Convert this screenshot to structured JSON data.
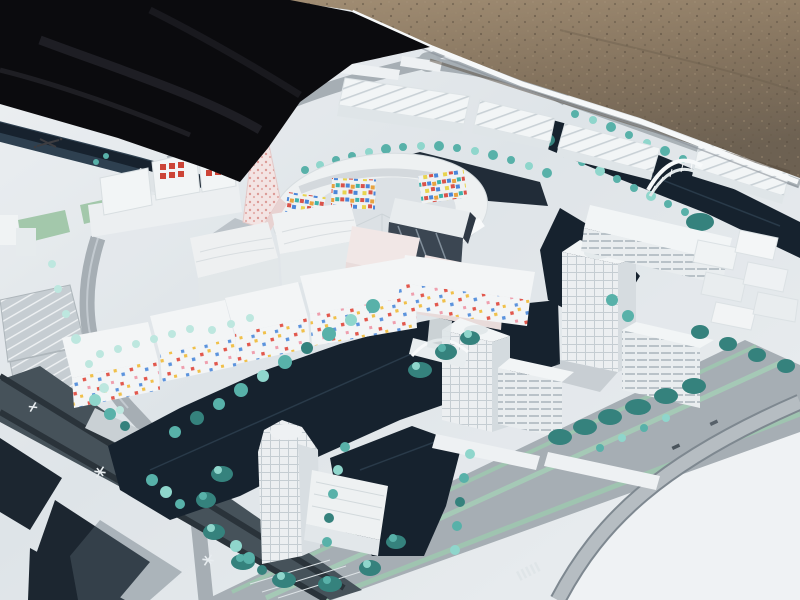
{
  "scene": {
    "subject": "outdoor photograph of a white architectural scale model of a canal-side urban district",
    "ground": "sandy gravel",
    "cover": "black tarp draped at upper left"
  },
  "colors": {
    "tarp": "#0b0b0e",
    "tarp_fold": "#26262d",
    "sand": "#8a7963",
    "sand_dark": "#5f5344",
    "sand_light": "#a6937a",
    "board": "#e4e9ec",
    "board_bright": "#f1f4f6",
    "board_edge": "#f6f8f9",
    "road": "#a6aeb4",
    "road_dark": "#46525a",
    "road_gutter": "#2a333a",
    "road_light": "#b6bdc2",
    "water": "#16222e",
    "water_edge": "#2e4050",
    "basin": "#1c2630",
    "tree_bright": "#8fd6cc",
    "tree_mid": "#58b1a9",
    "tree_dark": "#35827d",
    "tree_pale": "#bde7df",
    "grass": "#a3c8ab",
    "median": "#9fc4b0",
    "bldg_roof": "#f2f5f6",
    "bldg_face": "#e6ebed",
    "bldg_side": "#cfd6da",
    "shadow": "#5b6873",
    "glass": "#3b4652",
    "glass_streak": "#93a1ad",
    "pink_base": "#f3e4e3",
    "pink_dot": "#dc9a96",
    "red_window": "#cc4437",
    "bridge": "#f7f9fa",
    "mosaic_red": "#d9534a",
    "mosaic_blue": "#4a86d9",
    "mosaic_orange": "#e8a23f",
    "mosaic_teal": "#3fb3ab",
    "mosaic_yellow": "#e8d44f",
    "confetti_red": "#e2574c",
    "confetti_yellow": "#f0c04a",
    "confetti_blue": "#5b93dd",
    "confetti_pink": "#ef9fae"
  }
}
